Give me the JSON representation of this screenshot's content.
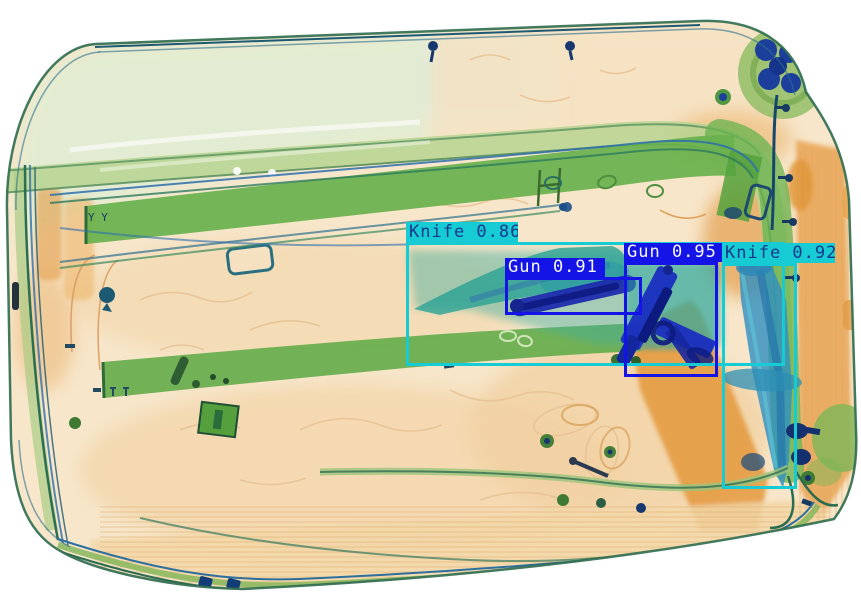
{
  "detections": [
    {
      "label": "Knife",
      "score": "0.86",
      "display": "Knife 0.86",
      "theme": "knife",
      "box": {
        "x": 406,
        "y": 242,
        "w": 379,
        "h": 124
      },
      "tag": {
        "x": 406,
        "y": 222,
        "w": 112,
        "h": 20
      }
    },
    {
      "label": "Gun",
      "score": "0.91",
      "display": "Gun 0.91",
      "theme": "gun",
      "box": {
        "x": 505,
        "y": 277,
        "w": 137,
        "h": 38
      },
      "tag": {
        "x": 505,
        "y": 258,
        "w": 100,
        "h": 19
      }
    },
    {
      "label": "Gun",
      "score": "0.95",
      "display": "Gun 0.95",
      "theme": "gun",
      "box": {
        "x": 624,
        "y": 262,
        "w": 94,
        "h": 115
      },
      "tag": {
        "x": 624,
        "y": 243,
        "w": 99,
        "h": 19
      }
    },
    {
      "label": "Knife",
      "score": "0.92",
      "display": "Knife 0.92",
      "theme": "knife",
      "box": {
        "x": 722,
        "y": 263,
        "w": 75,
        "h": 226
      },
      "tag": {
        "x": 722,
        "y": 243,
        "w": 113,
        "h": 20
      }
    }
  ],
  "themes": {
    "knife": {
      "box_color": "#16cbd4",
      "label_bg": "#16cbd4",
      "label_text": "#14388a"
    },
    "gun": {
      "box_color": "#1414e6",
      "label_bg": "#1414e6",
      "label_text": "#f5f7ff"
    }
  }
}
